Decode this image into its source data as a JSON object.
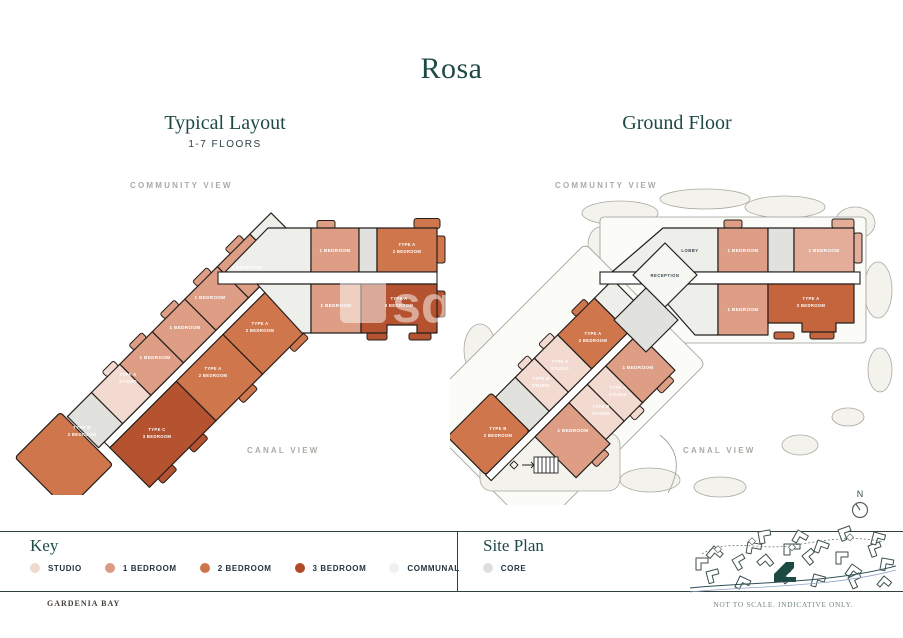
{
  "title": "Rosa",
  "plans": {
    "typical": {
      "title": "Typical Layout",
      "subtitle": "1-7 FLOORS"
    },
    "ground": {
      "title": "Ground Floor"
    }
  },
  "views": {
    "community": "COMMUNITY VIEW",
    "canal": "CANAL VIEW"
  },
  "units": {
    "one_bed": "1 BEDROOM",
    "two_bed": "2 BEDROOM",
    "three_bed": "3 BEDROOM",
    "studio": "STUDIO",
    "type_a": "TYPE A",
    "type_b": "TYPE B",
    "type_c": "TYPE C",
    "lobby": "LOBBY",
    "reception": "RECEPTION"
  },
  "key": {
    "title": "Key",
    "items": [
      {
        "label": "STUDIO",
        "color": "#f2d9cf"
      },
      {
        "label": "1 BEDROOM",
        "color": "#db9b82"
      },
      {
        "label": "2 BEDROOM",
        "color": "#cf744a"
      },
      {
        "label": "3 BEDROOM",
        "color": "#b04a28"
      },
      {
        "label": "COMMUNAL",
        "color": "#f1f0ec"
      },
      {
        "label": "CORE",
        "color": "#dedfdb"
      }
    ]
  },
  "site_plan": {
    "title": "Site Plan"
  },
  "compass": {
    "label": "N"
  },
  "watermark": {
    "line1": "sq",
    "line2": "ya"
  },
  "footer": {
    "brand": "GARDENIA BAY",
    "disclaimer": "NOT TO SCALE. INDICATIVE ONLY."
  },
  "colors": {
    "accent_teal": "#1d4a44",
    "studio": "#f3dad0",
    "one_bedroom": "#dd9e85",
    "two_bedroom": "#d0764c",
    "three_bedroom": "#b5522f",
    "communal": "#eeeeea",
    "core": "#e1e1dd"
  }
}
